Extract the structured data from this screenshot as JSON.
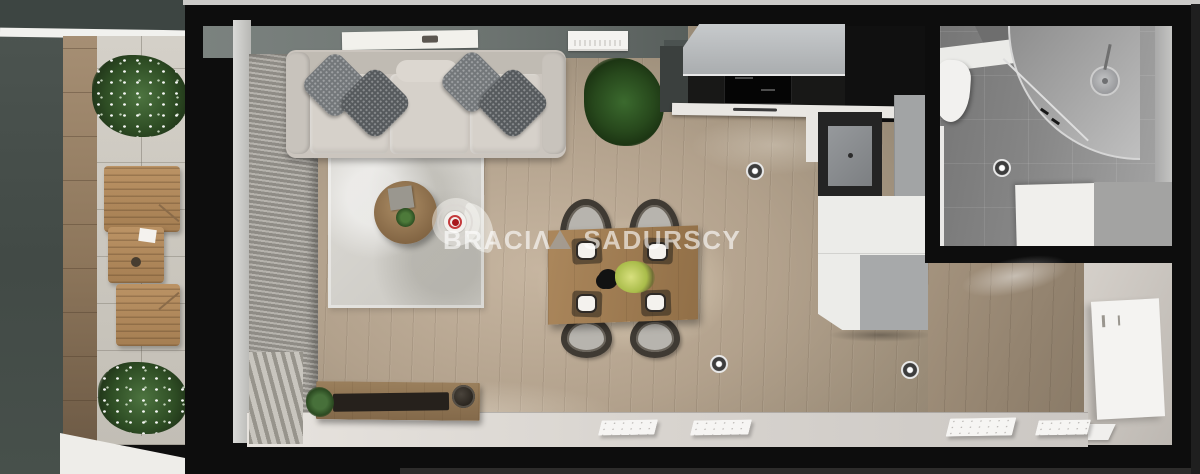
{
  "watermark": {
    "brand_left": "BRACI",
    "logo_letter": "Λ",
    "brand_right": "SADURSCY"
  },
  "colors": {
    "logo_red": "#bf2328",
    "wall_black": "#0d0d0d",
    "floor_wood": "#b2a28d",
    "bathroom_tile": "#8a8a8a",
    "balcony_wall": "#48504c",
    "sofa_grey": "#cbc5be",
    "watermark_text": "rgba(255,255,255,0.62)"
  }
}
